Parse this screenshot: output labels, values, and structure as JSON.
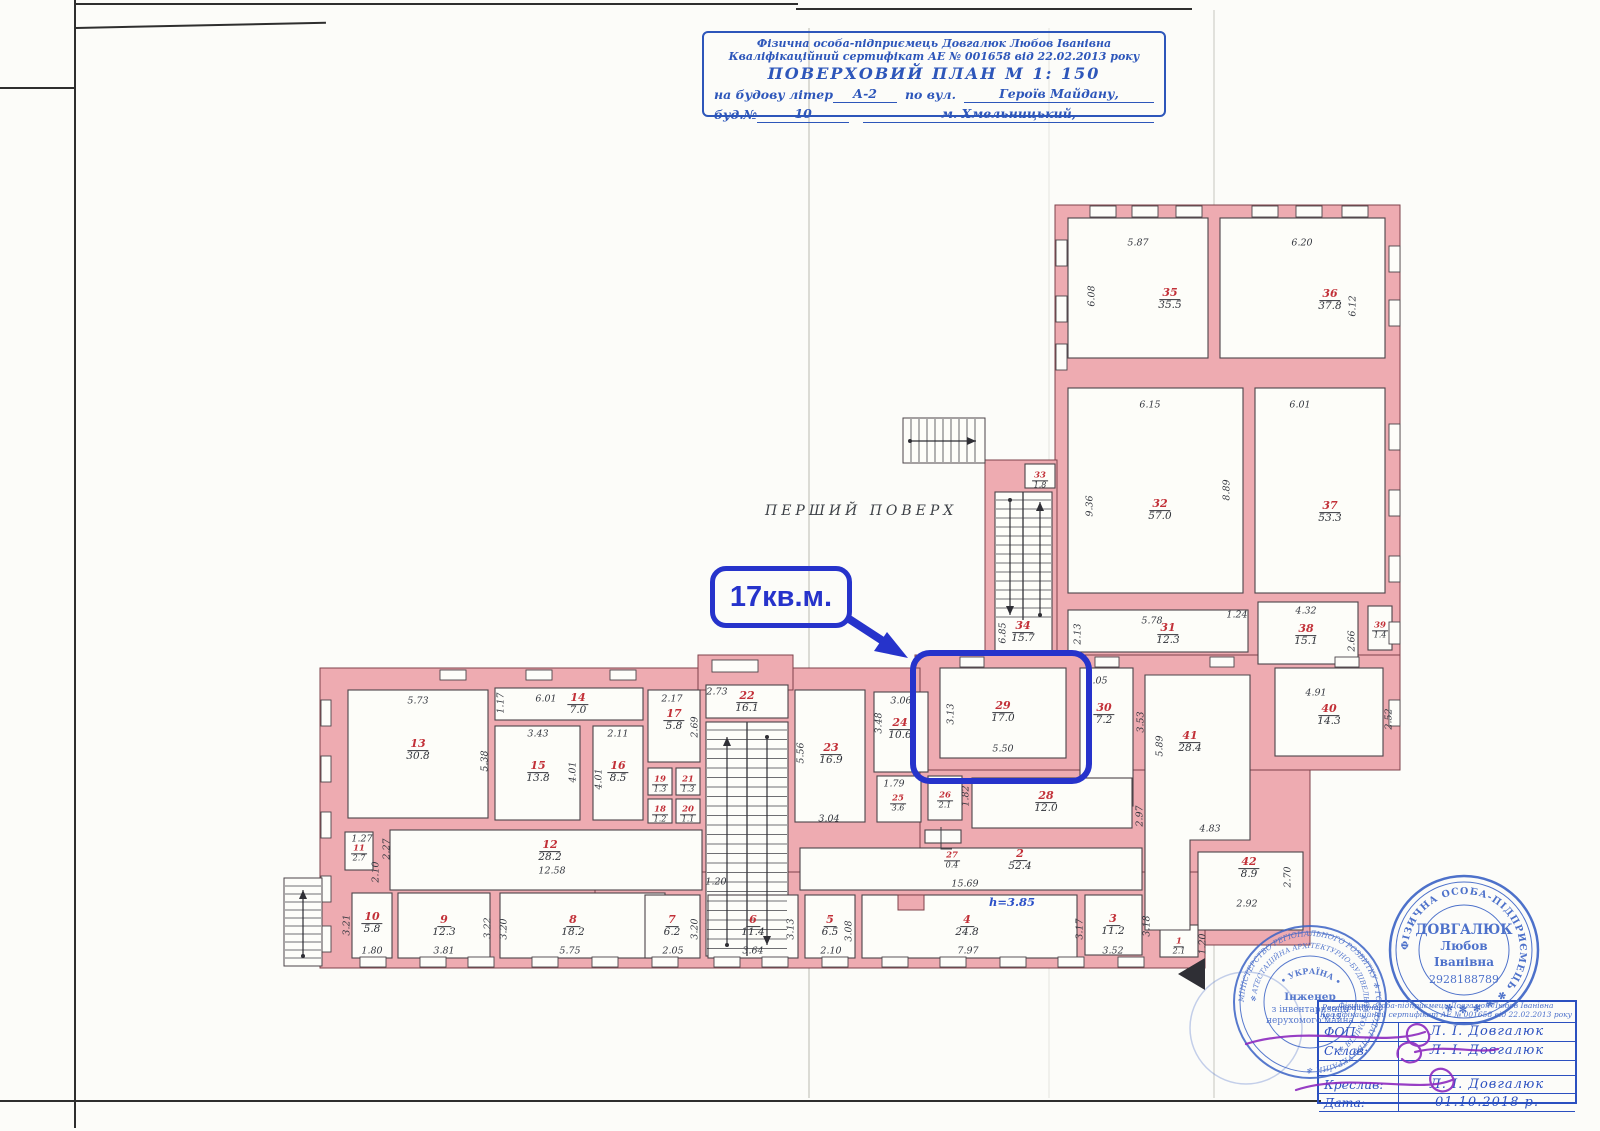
{
  "title_block": {
    "line1": "Фізична особа-підприємець Довгалюк Любов Іванівна",
    "line2": "Кваліфікаційний сертифікат АЕ № 001658 від 22.02.2013 року",
    "line3": "ПОВЕРХОВИЙ  ПЛАН    М 1: 150",
    "line4_prefix": "на будову літер",
    "line4_value": "А-2",
    "line4_mid": "по вул.",
    "line4_street": "Героїв Майдану,",
    "line5_prefix": "буд.№",
    "line5_num": "10",
    "line5_city": "м. Хмельницький,"
  },
  "annotations": {
    "floor_label": "ПЕРШИЙ ПОВЕРХ",
    "area_callout": "17кв.м.",
    "height_note": "h=3.85"
  },
  "plan": {
    "rooms": [
      {
        "n": "35",
        "a": "35.5",
        "x": 1170,
        "y": 297,
        "s": 0
      },
      {
        "n": "36",
        "a": "37.8",
        "x": 1330,
        "y": 298,
        "s": 0
      },
      {
        "n": "32",
        "a": "57.0",
        "x": 1160,
        "y": 508,
        "s": 0
      },
      {
        "n": "37",
        "a": "53.3",
        "x": 1330,
        "y": 510,
        "s": 0
      },
      {
        "n": "33",
        "a": "1.8",
        "x": 1040,
        "y": 477,
        "s": 1
      },
      {
        "n": "34",
        "a": "15.7",
        "x": 1023,
        "y": 630,
        "s": 0
      },
      {
        "n": "31",
        "a": "12.3",
        "x": 1168,
        "y": 632,
        "s": 0
      },
      {
        "n": "38",
        "a": "15.1",
        "x": 1306,
        "y": 633,
        "s": 0
      },
      {
        "n": "39",
        "a": "1.4",
        "x": 1380,
        "y": 627,
        "s": 1
      },
      {
        "n": "29",
        "a": "17.0",
        "x": 1003,
        "y": 710,
        "s": 0
      },
      {
        "n": "30",
        "a": "7.2",
        "x": 1104,
        "y": 712,
        "s": 0
      },
      {
        "n": "40",
        "a": "14.3",
        "x": 1329,
        "y": 713,
        "s": 0
      },
      {
        "n": "41",
        "a": "28.4",
        "x": 1190,
        "y": 740,
        "s": 0
      },
      {
        "n": "42",
        "a": "8.9",
        "x": 1249,
        "y": 866,
        "s": 0
      },
      {
        "n": "28",
        "a": "12.0",
        "x": 1046,
        "y": 800,
        "s": 0
      },
      {
        "n": "27",
        "a": "0.4",
        "x": 952,
        "y": 857,
        "s": 1
      },
      {
        "n": "2",
        "a": "52.4",
        "x": 1020,
        "y": 858,
        "s": 0
      },
      {
        "n": "22",
        "a": "16.1",
        "x": 747,
        "y": 700,
        "s": 0
      },
      {
        "n": "23",
        "a": "16.9",
        "x": 831,
        "y": 752,
        "s": 0
      },
      {
        "n": "24",
        "a": "10.6",
        "x": 900,
        "y": 727,
        "s": 0
      },
      {
        "n": "25",
        "a": "3.6",
        "x": 898,
        "y": 800,
        "s": 1
      },
      {
        "n": "26",
        "a": "2.1",
        "x": 945,
        "y": 797,
        "s": 1
      },
      {
        "n": "17",
        "a": "5.8",
        "x": 674,
        "y": 718,
        "s": 0
      },
      {
        "n": "19",
        "a": "1.3",
        "x": 660,
        "y": 781,
        "s": 1
      },
      {
        "n": "21",
        "a": "1.3",
        "x": 688,
        "y": 781,
        "s": 1
      },
      {
        "n": "18",
        "a": "1.2",
        "x": 660,
        "y": 811,
        "s": 1
      },
      {
        "n": "20",
        "a": "1.1",
        "x": 688,
        "y": 811,
        "s": 1
      },
      {
        "n": "13",
        "a": "30.8",
        "x": 418,
        "y": 748,
        "s": 0
      },
      {
        "n": "14",
        "a": "7.0",
        "x": 578,
        "y": 702,
        "s": 0
      },
      {
        "n": "15",
        "a": "13.8",
        "x": 538,
        "y": 770,
        "s": 0
      },
      {
        "n": "16",
        "a": "8.5",
        "x": 618,
        "y": 770,
        "s": 0
      },
      {
        "n": "12",
        "a": "28.2",
        "x": 550,
        "y": 849,
        "s": 0
      },
      {
        "n": "11",
        "a": "2.7",
        "x": 359,
        "y": 850,
        "s": 1
      },
      {
        "n": "10",
        "a": "5.8",
        "x": 372,
        "y": 921,
        "s": 0
      },
      {
        "n": "9",
        "a": "12.3",
        "x": 444,
        "y": 924,
        "s": 0
      },
      {
        "n": "8",
        "a": "18.2",
        "x": 573,
        "y": 924,
        "s": 0
      },
      {
        "n": "7",
        "a": "6.2",
        "x": 672,
        "y": 924,
        "s": 0
      },
      {
        "n": "6",
        "a": "11.4",
        "x": 753,
        "y": 924,
        "s": 0
      },
      {
        "n": "5",
        "a": "6.5",
        "x": 830,
        "y": 924,
        "s": 0
      },
      {
        "n": "4",
        "a": "24.8",
        "x": 967,
        "y": 924,
        "s": 0
      },
      {
        "n": "3",
        "a": "11.2",
        "x": 1113,
        "y": 923,
        "s": 0
      },
      {
        "n": "1",
        "a": "2.1",
        "x": 1179,
        "y": 943,
        "s": 1
      }
    ],
    "dims": [
      {
        "t": "5.87",
        "x": 1138,
        "y": 243,
        "r": 0
      },
      {
        "t": "6.20",
        "x": 1302,
        "y": 243,
        "r": 0
      },
      {
        "t": "6.08",
        "x": 1092,
        "y": 296,
        "r": 1
      },
      {
        "t": "6.12",
        "x": 1353,
        "y": 306,
        "r": 1
      },
      {
        "t": "6.15",
        "x": 1150,
        "y": 405,
        "r": 0
      },
      {
        "t": "6.01",
        "x": 1300,
        "y": 405,
        "r": 0
      },
      {
        "t": "9.36",
        "x": 1090,
        "y": 506,
        "r": 1
      },
      {
        "t": "8.89",
        "x": 1227,
        "y": 490,
        "r": 1
      },
      {
        "t": "5.78",
        "x": 1152,
        "y": 621,
        "r": 0
      },
      {
        "t": "2.13",
        "x": 1078,
        "y": 634,
        "r": 1
      },
      {
        "t": "1.24",
        "x": 1237,
        "y": 615,
        "r": 0
      },
      {
        "t": "4.32",
        "x": 1306,
        "y": 611,
        "r": 0
      },
      {
        "t": "2.66",
        "x": 1352,
        "y": 641,
        "r": 1
      },
      {
        "t": "6.85",
        "x": 1003,
        "y": 633,
        "r": 1
      },
      {
        "t": "2.05",
        "x": 1097,
        "y": 681,
        "r": 0
      },
      {
        "t": "4.91",
        "x": 1316,
        "y": 693,
        "r": 0
      },
      {
        "t": "2.52",
        "x": 1389,
        "y": 719,
        "r": 1
      },
      {
        "t": "3.13",
        "x": 951,
        "y": 714,
        "r": 1
      },
      {
        "t": "5.50",
        "x": 1003,
        "y": 749,
        "r": 0
      },
      {
        "t": "3.53",
        "x": 1141,
        "y": 722,
        "r": 1
      },
      {
        "t": "5.89",
        "x": 1160,
        "y": 746,
        "r": 1
      },
      {
        "t": "2.97",
        "x": 1140,
        "y": 816,
        "r": 1
      },
      {
        "t": "4.83",
        "x": 1210,
        "y": 829,
        "r": 0
      },
      {
        "t": "2.70",
        "x": 1288,
        "y": 877,
        "r": 1
      },
      {
        "t": "2.92",
        "x": 1247,
        "y": 904,
        "r": 0
      },
      {
        "t": "1.82",
        "x": 966,
        "y": 796,
        "r": 1
      },
      {
        "t": "15.69",
        "x": 965,
        "y": 884,
        "r": 0
      },
      {
        "t": "1.20",
        "x": 716,
        "y": 882,
        "r": 0
      },
      {
        "t": "5.73",
        "x": 418,
        "y": 701,
        "r": 0
      },
      {
        "t": "1.17",
        "x": 501,
        "y": 703,
        "r": 1
      },
      {
        "t": "6.01",
        "x": 546,
        "y": 699,
        "r": 0
      },
      {
        "t": "2.17",
        "x": 672,
        "y": 699,
        "r": 0
      },
      {
        "t": "2.73",
        "x": 717,
        "y": 692,
        "r": 0
      },
      {
        "t": "3.43",
        "x": 538,
        "y": 734,
        "r": 0
      },
      {
        "t": "2.11",
        "x": 618,
        "y": 734,
        "r": 0
      },
      {
        "t": "5.38",
        "x": 485,
        "y": 761,
        "r": 1
      },
      {
        "t": "4.01",
        "x": 573,
        "y": 772,
        "r": 1
      },
      {
        "t": "4.01",
        "x": 599,
        "y": 779,
        "r": 1
      },
      {
        "t": "2.69",
        "x": 695,
        "y": 727,
        "r": 1
      },
      {
        "t": "1.27",
        "x": 362,
        "y": 839,
        "r": 0
      },
      {
        "t": "2.27",
        "x": 387,
        "y": 849,
        "r": 1
      },
      {
        "t": "2.10",
        "x": 376,
        "y": 872,
        "r": 1
      },
      {
        "t": "12.58",
        "x": 552,
        "y": 871,
        "r": 0
      },
      {
        "t": "5.56",
        "x": 801,
        "y": 753,
        "r": 1
      },
      {
        "t": "3.04",
        "x": 829,
        "y": 819,
        "r": 0
      },
      {
        "t": "3.06",
        "x": 901,
        "y": 701,
        "r": 0
      },
      {
        "t": "3.48",
        "x": 879,
        "y": 723,
        "r": 1
      },
      {
        "t": "1.79",
        "x": 894,
        "y": 784,
        "r": 0
      },
      {
        "t": "3.21",
        "x": 347,
        "y": 925,
        "r": 1
      },
      {
        "t": "1.80",
        "x": 372,
        "y": 951,
        "r": 0
      },
      {
        "t": "3.81",
        "x": 444,
        "y": 951,
        "r": 0
      },
      {
        "t": "3.22",
        "x": 488,
        "y": 928,
        "r": 1
      },
      {
        "t": "3.20",
        "x": 504,
        "y": 929,
        "r": 1
      },
      {
        "t": "5.75",
        "x": 570,
        "y": 951,
        "r": 0
      },
      {
        "t": "2.05",
        "x": 673,
        "y": 951,
        "r": 0
      },
      {
        "t": "3.20",
        "x": 695,
        "y": 929,
        "r": 1
      },
      {
        "t": "3.64",
        "x": 753,
        "y": 951,
        "r": 0
      },
      {
        "t": "3.13",
        "x": 791,
        "y": 929,
        "r": 1
      },
      {
        "t": "2.10",
        "x": 831,
        "y": 951,
        "r": 0
      },
      {
        "t": "3.08",
        "x": 849,
        "y": 931,
        "r": 1
      },
      {
        "t": "7.97",
        "x": 968,
        "y": 951,
        "r": 0
      },
      {
        "t": "3.17",
        "x": 1080,
        "y": 929,
        "r": 1
      },
      {
        "t": "3.52",
        "x": 1113,
        "y": 951,
        "r": 0
      },
      {
        "t": "3.18",
        "x": 1147,
        "y": 926,
        "r": 1
      },
      {
        "t": "1.20",
        "x": 1203,
        "y": 944,
        "r": 1
      }
    ]
  },
  "stamp_left": {
    "ring_outer": "МІНІСТЕРСТВО РЕГІОНАЛЬНОГО РОЗВИТКУ ✻ ГОСПОДАРСТВА УКРАЇНИ ✻",
    "ring_inner": "✻ АТЕСТАЦІЙНА АРХІТЕКТУРНО-БУДІВЕЛЬНА КОМІСІЯ ✻",
    "arc": "• УКРАЇНА •",
    "line1": "Інженер",
    "line2": "з інвентаризації",
    "line3": "нерухомого майна"
  },
  "stamp_right": {
    "ring": "ФІЗИЧНА ОСОБА-ПІДПРИЄМЕЦЬ ✻ ✻ ✻ ✻ ✻",
    "name1": "ДОВГАЛЮК",
    "name2": "Любов",
    "name3": "Іванівна",
    "id": "2928188789"
  },
  "table": {
    "reg1": "Реєстраційний",
    "reg2": "№ 15",
    "stamp_line1": "Фізична особа-підприємець Довгалюк Любов Іванівна",
    "stamp_line2": "Кваліфікаційний сертифікат АЕ № 001658 від 22.02.2013 року",
    "rows": [
      {
        "label": "ФОП",
        "value": "Л. І. Довгалюк"
      },
      {
        "label": "Склав:",
        "value": "Л. І. Довгалюк"
      },
      {
        "label": "",
        "value": ""
      },
      {
        "label": "Креслив:",
        "value": "Л. І. Довгалюк"
      },
      {
        "label": "Дата:",
        "value": "01.10.2018 р."
      }
    ]
  }
}
